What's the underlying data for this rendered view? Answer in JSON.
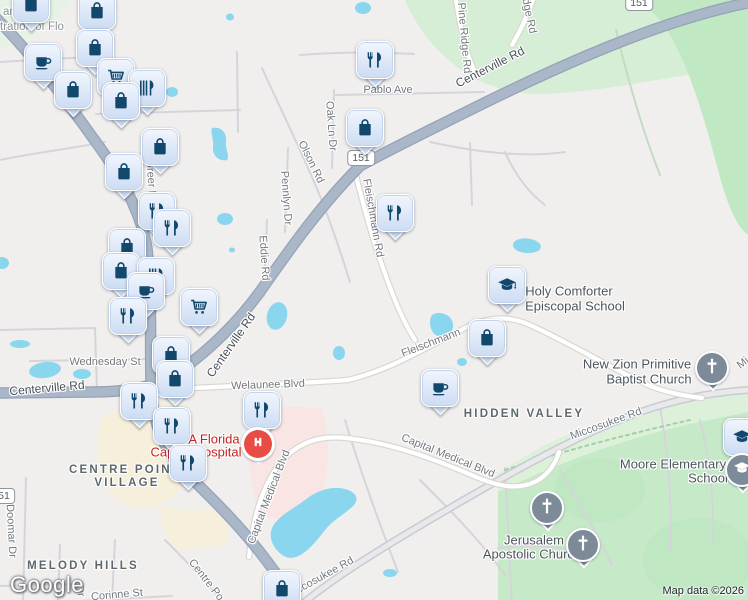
{
  "map": {
    "attribution": "Map data ©2026",
    "logo": "Google",
    "colors": {
      "land": "#f0efee",
      "park_green": "#c6e9c8",
      "pale_green": "#d7eed6",
      "water": "#8ad6ee",
      "major_road": "#a9b7c8",
      "commercial": "#f5efdc",
      "hospital_area": "#f9e6e4",
      "pin_fill": "#dde8f8",
      "pin_icon": "#12486b",
      "church_pin": "#7d8b99",
      "hospital_red": "#e84c44",
      "poi_red_text": "#c5221f"
    },
    "shields": [
      {
        "t": "151",
        "x": 361,
        "y": 158
      },
      {
        "t": "151",
        "x": 639,
        "y": 3
      },
      {
        "t": "51",
        "x": 4,
        "y": 496
      }
    ],
    "labels": [
      {
        "t": "ard of",
        "x": 3,
        "y": 12,
        "r": 0,
        "cls": "meta",
        "a": "l",
        "i": false
      },
      {
        "t": "tration of Flo",
        "x": 0,
        "y": 27,
        "r": 0,
        "cls": "meta",
        "a": "l",
        "i": false
      },
      {
        "t": "Pablo Ave",
        "x": 388,
        "y": 90,
        "r": 0,
        "cls": "st",
        "i": false
      },
      {
        "t": "Oak Ln Dr",
        "x": 331,
        "y": 126,
        "r": 86,
        "cls": "st",
        "i": false
      },
      {
        "t": "Olson Rd",
        "x": 311,
        "y": 162,
        "r": 64,
        "cls": "st",
        "i": false
      },
      {
        "t": "Pennlyn Dr",
        "x": 286,
        "y": 198,
        "r": 86,
        "cls": "st",
        "i": false
      },
      {
        "t": "Eddie Rd",
        "x": 264,
        "y": 258,
        "r": 86,
        "cls": "st",
        "i": false
      },
      {
        "t": "Fleischmann Rd",
        "x": 373,
        "y": 218,
        "r": 80,
        "cls": "st",
        "i": false
      },
      {
        "t": "Pine Ridge Rd",
        "x": 464,
        "y": 38,
        "r": 85,
        "cls": "st",
        "i": false
      },
      {
        "t": "dge Rd",
        "x": 529,
        "y": 16,
        "r": 78,
        "cls": "st",
        "i": false
      },
      {
        "t": "Greer Rd",
        "x": 151,
        "y": 182,
        "r": 86,
        "cls": "st",
        "i": false
      },
      {
        "t": "Wednesday St",
        "x": 105,
        "y": 362,
        "r": 0,
        "cls": "st",
        "i": false
      },
      {
        "t": "Welaunee Blvd",
        "x": 268,
        "y": 385,
        "r": -2,
        "cls": "st",
        "i": false
      },
      {
        "t": "Fleischmann",
        "x": 431,
        "y": 343,
        "r": -21,
        "cls": "st",
        "i": false
      },
      {
        "t": "Miccosukee Rd",
        "x": 606,
        "y": 424,
        "r": -20,
        "cls": "st",
        "i": false
      },
      {
        "t": "Miccosukee Rd",
        "x": 320,
        "y": 578,
        "r": -29,
        "cls": "st",
        "i": false
      },
      {
        "t": "Mi",
        "x": 743,
        "y": 363,
        "r": -38,
        "cls": "st",
        "i": false
      },
      {
        "t": "Capital Medical Blvd",
        "x": 448,
        "y": 456,
        "r": 22,
        "cls": "st",
        "i": false
      },
      {
        "t": "Capital Medical Blvd",
        "x": 269,
        "y": 497,
        "r": -69,
        "cls": "st",
        "i": false
      },
      {
        "t": "Corinne St",
        "x": 117,
        "y": 595,
        "r": -5,
        "cls": "st",
        "i": false
      },
      {
        "t": "Centre Po",
        "x": 206,
        "y": 580,
        "r": 52,
        "cls": "st",
        "i": false
      },
      {
        "t": "Doomar Dr",
        "x": 11,
        "y": 531,
        "r": 87,
        "cls": "st",
        "i": false
      },
      {
        "t": "Dr",
        "x": 80,
        "y": 591,
        "r": 80,
        "cls": "st",
        "i": false
      },
      {
        "t": "Centerville Rd",
        "x": 490,
        "y": 67,
        "r": -27,
        "cls": "stD",
        "i": false
      },
      {
        "t": "Centerville Rd",
        "x": 231,
        "y": 345,
        "r": -55,
        "cls": "stD",
        "i": false
      },
      {
        "t": "Centerville Rd",
        "x": 47,
        "y": 388,
        "r": -5,
        "cls": "stD",
        "i": false
      },
      {
        "t": "HIDDEN VALLEY",
        "x": 524,
        "y": 414,
        "r": 0,
        "cls": "area",
        "i": false
      },
      {
        "t": "CENTRE POINT",
        "x": 125,
        "y": 470,
        "r": 0,
        "cls": "area",
        "i": false
      },
      {
        "t": "VILLAGE",
        "x": 127,
        "y": 483,
        "r": 0,
        "cls": "area",
        "i": false
      },
      {
        "t": "MELODY HILLS",
        "x": 83,
        "y": 566,
        "r": 0,
        "cls": "area",
        "i": false
      },
      {
        "t": "Holy Comforter",
        "x": 569,
        "y": 291,
        "r": 0,
        "cls": "poi",
        "i": true
      },
      {
        "t": "Episcopal School",
        "x": 575,
        "y": 306,
        "r": 0,
        "cls": "poi",
        "i": true
      },
      {
        "t": "New Zion Primitive",
        "x": 637,
        "y": 364,
        "r": 0,
        "cls": "poi",
        "i": true
      },
      {
        "t": "Baptist Church",
        "x": 649,
        "y": 379,
        "r": 0,
        "cls": "poi",
        "i": true
      },
      {
        "t": "Moore Elementary",
        "x": 673,
        "y": 464,
        "r": 0,
        "cls": "poi",
        "i": true
      },
      {
        "t": "School",
        "x": 708,
        "y": 478,
        "r": 0,
        "cls": "poi",
        "i": true
      },
      {
        "t": "Jerusalem",
        "x": 534,
        "y": 540,
        "r": 0,
        "cls": "poi",
        "i": true
      },
      {
        "t": "Apostolic Church",
        "x": 532,
        "y": 554,
        "r": 0,
        "cls": "poi",
        "i": true
      },
      {
        "t": "A Florida",
        "x": 214,
        "y": 439,
        "r": 0,
        "cls": "poiRed",
        "i": true
      },
      {
        "t": "Capital Hospital",
        "x": 196,
        "y": 452,
        "r": 0,
        "cls": "poiRed",
        "i": true
      }
    ],
    "markers": [
      {
        "icon": "shopping-bag",
        "x": 31,
        "y": 4
      },
      {
        "icon": "shopping-bag",
        "x": 97,
        "y": 11
      },
      {
        "icon": "shopping-bag",
        "x": 95,
        "y": 48
      },
      {
        "icon": "restaurant",
        "x": 375,
        "y": 60
      },
      {
        "icon": "coffee",
        "x": 43,
        "y": 62
      },
      {
        "icon": "shopping-cart",
        "x": 116,
        "y": 77
      },
      {
        "icon": "dining",
        "x": 147,
        "y": 88
      },
      {
        "icon": "shopping-bag",
        "x": 73,
        "y": 90
      },
      {
        "icon": "shopping-bag",
        "x": 121,
        "y": 101
      },
      {
        "icon": "shopping-bag",
        "x": 365,
        "y": 128
      },
      {
        "icon": "shopping-bag",
        "x": 160,
        "y": 147
      },
      {
        "icon": "shopping-bag",
        "x": 124,
        "y": 172
      },
      {
        "icon": "restaurant",
        "x": 157,
        "y": 211
      },
      {
        "icon": "restaurant",
        "x": 395,
        "y": 213
      },
      {
        "icon": "restaurant",
        "x": 172,
        "y": 228
      },
      {
        "icon": "shopping-bag",
        "x": 127,
        "y": 247
      },
      {
        "icon": "shopping-bag",
        "x": 121,
        "y": 271
      },
      {
        "icon": "dining",
        "x": 156,
        "y": 276
      },
      {
        "icon": "school",
        "x": 507,
        "y": 285
      },
      {
        "icon": "coffee",
        "x": 146,
        "y": 291
      },
      {
        "icon": "shopping-cart",
        "x": 199,
        "y": 307
      },
      {
        "icon": "restaurant",
        "x": 128,
        "y": 316
      },
      {
        "icon": "shopping-bag",
        "x": 487,
        "y": 338
      },
      {
        "icon": "shopping-bag",
        "x": 171,
        "y": 355
      },
      {
        "icon": "church",
        "x": 712,
        "y": 368
      },
      {
        "icon": "shopping-bag",
        "x": 175,
        "y": 379
      },
      {
        "icon": "coffee",
        "x": 440,
        "y": 388
      },
      {
        "icon": "restaurant",
        "x": 139,
        "y": 401
      },
      {
        "icon": "restaurant",
        "x": 262,
        "y": 410
      },
      {
        "icon": "restaurant",
        "x": 172,
        "y": 426
      },
      {
        "icon": "school",
        "x": 742,
        "y": 437
      },
      {
        "icon": "hospital",
        "x": 258,
        "y": 444
      },
      {
        "icon": "restaurant",
        "x": 188,
        "y": 463
      },
      {
        "icon": "school-dot",
        "x": 742,
        "y": 470
      },
      {
        "icon": "church",
        "x": 547,
        "y": 508
      },
      {
        "icon": "church",
        "x": 583,
        "y": 545
      },
      {
        "icon": "shopping-bag",
        "x": 282,
        "y": 589
      }
    ]
  }
}
